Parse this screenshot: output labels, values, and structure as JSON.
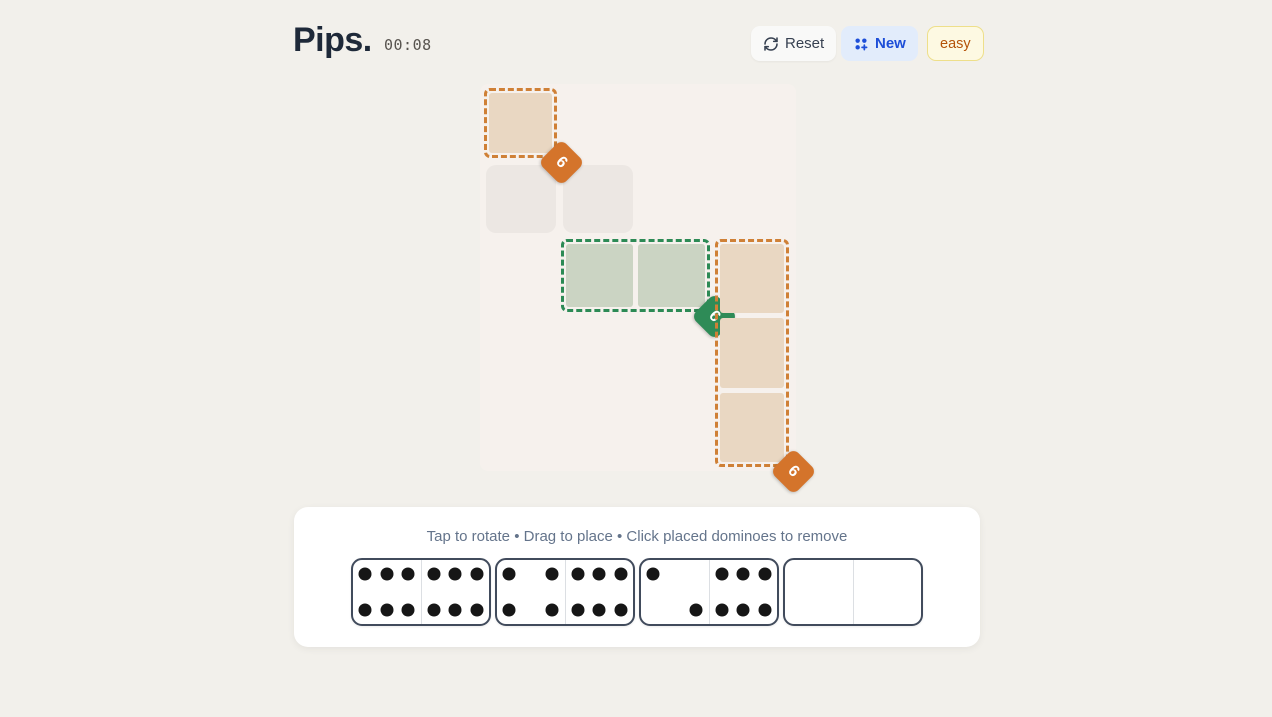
{
  "header": {
    "title": "Pips.",
    "timer": "00:08"
  },
  "toolbar": {
    "reset_label": "Reset",
    "new_label": "New",
    "difficulty_label": "easy"
  },
  "board": {
    "left": 480,
    "top": 84,
    "width": 316,
    "height": 387,
    "backdrop_color": "#f6f1ed",
    "free_cell_color": "#ece7e3",
    "free_cells": [
      {
        "left": 6,
        "top": 81,
        "width": 70,
        "height": 68
      },
      {
        "left": 83,
        "top": 81,
        "width": 70,
        "height": 68
      }
    ],
    "regions": [
      {
        "name": "orange-region-top-left",
        "color_key": "orange",
        "target": "6",
        "left": 4,
        "top": 4,
        "width": 73,
        "height": 70,
        "cols": 1,
        "rows": 1
      },
      {
        "name": "green-region-middle",
        "color_key": "green",
        "target": "6",
        "left": 81,
        "top": 155,
        "width": 149,
        "height": 73,
        "cols": 2,
        "rows": 1
      },
      {
        "name": "orange-region-right-column",
        "color_key": "orange",
        "target": "6",
        "left": 235,
        "top": 155,
        "width": 74,
        "height": 228,
        "cols": 1,
        "rows": 3
      }
    ]
  },
  "tray": {
    "instructions": "Tap to rotate • Drag to place • Click placed dominoes to remove",
    "dominoes": [
      {
        "name": "domino-6-6",
        "halves": [
          6,
          6
        ]
      },
      {
        "name": "domino-4-6",
        "halves": [
          4,
          6
        ]
      },
      {
        "name": "domino-2-6",
        "halves": [
          2,
          6
        ]
      },
      {
        "name": "domino-0-0",
        "halves": [
          0,
          0
        ]
      }
    ]
  },
  "colors": {
    "page_bg": "#f2f0eb",
    "orange_border": "#cf8036",
    "orange_fill": "#e9d7c2",
    "orange_badge": "#d4742b",
    "green_border": "#2c8a55",
    "green_fill": "#cbd4c3",
    "green_badge": "#2e8b57",
    "pip": "#161616",
    "accent_blue": "#1d4ed8",
    "difficulty_text": "#b45309"
  }
}
